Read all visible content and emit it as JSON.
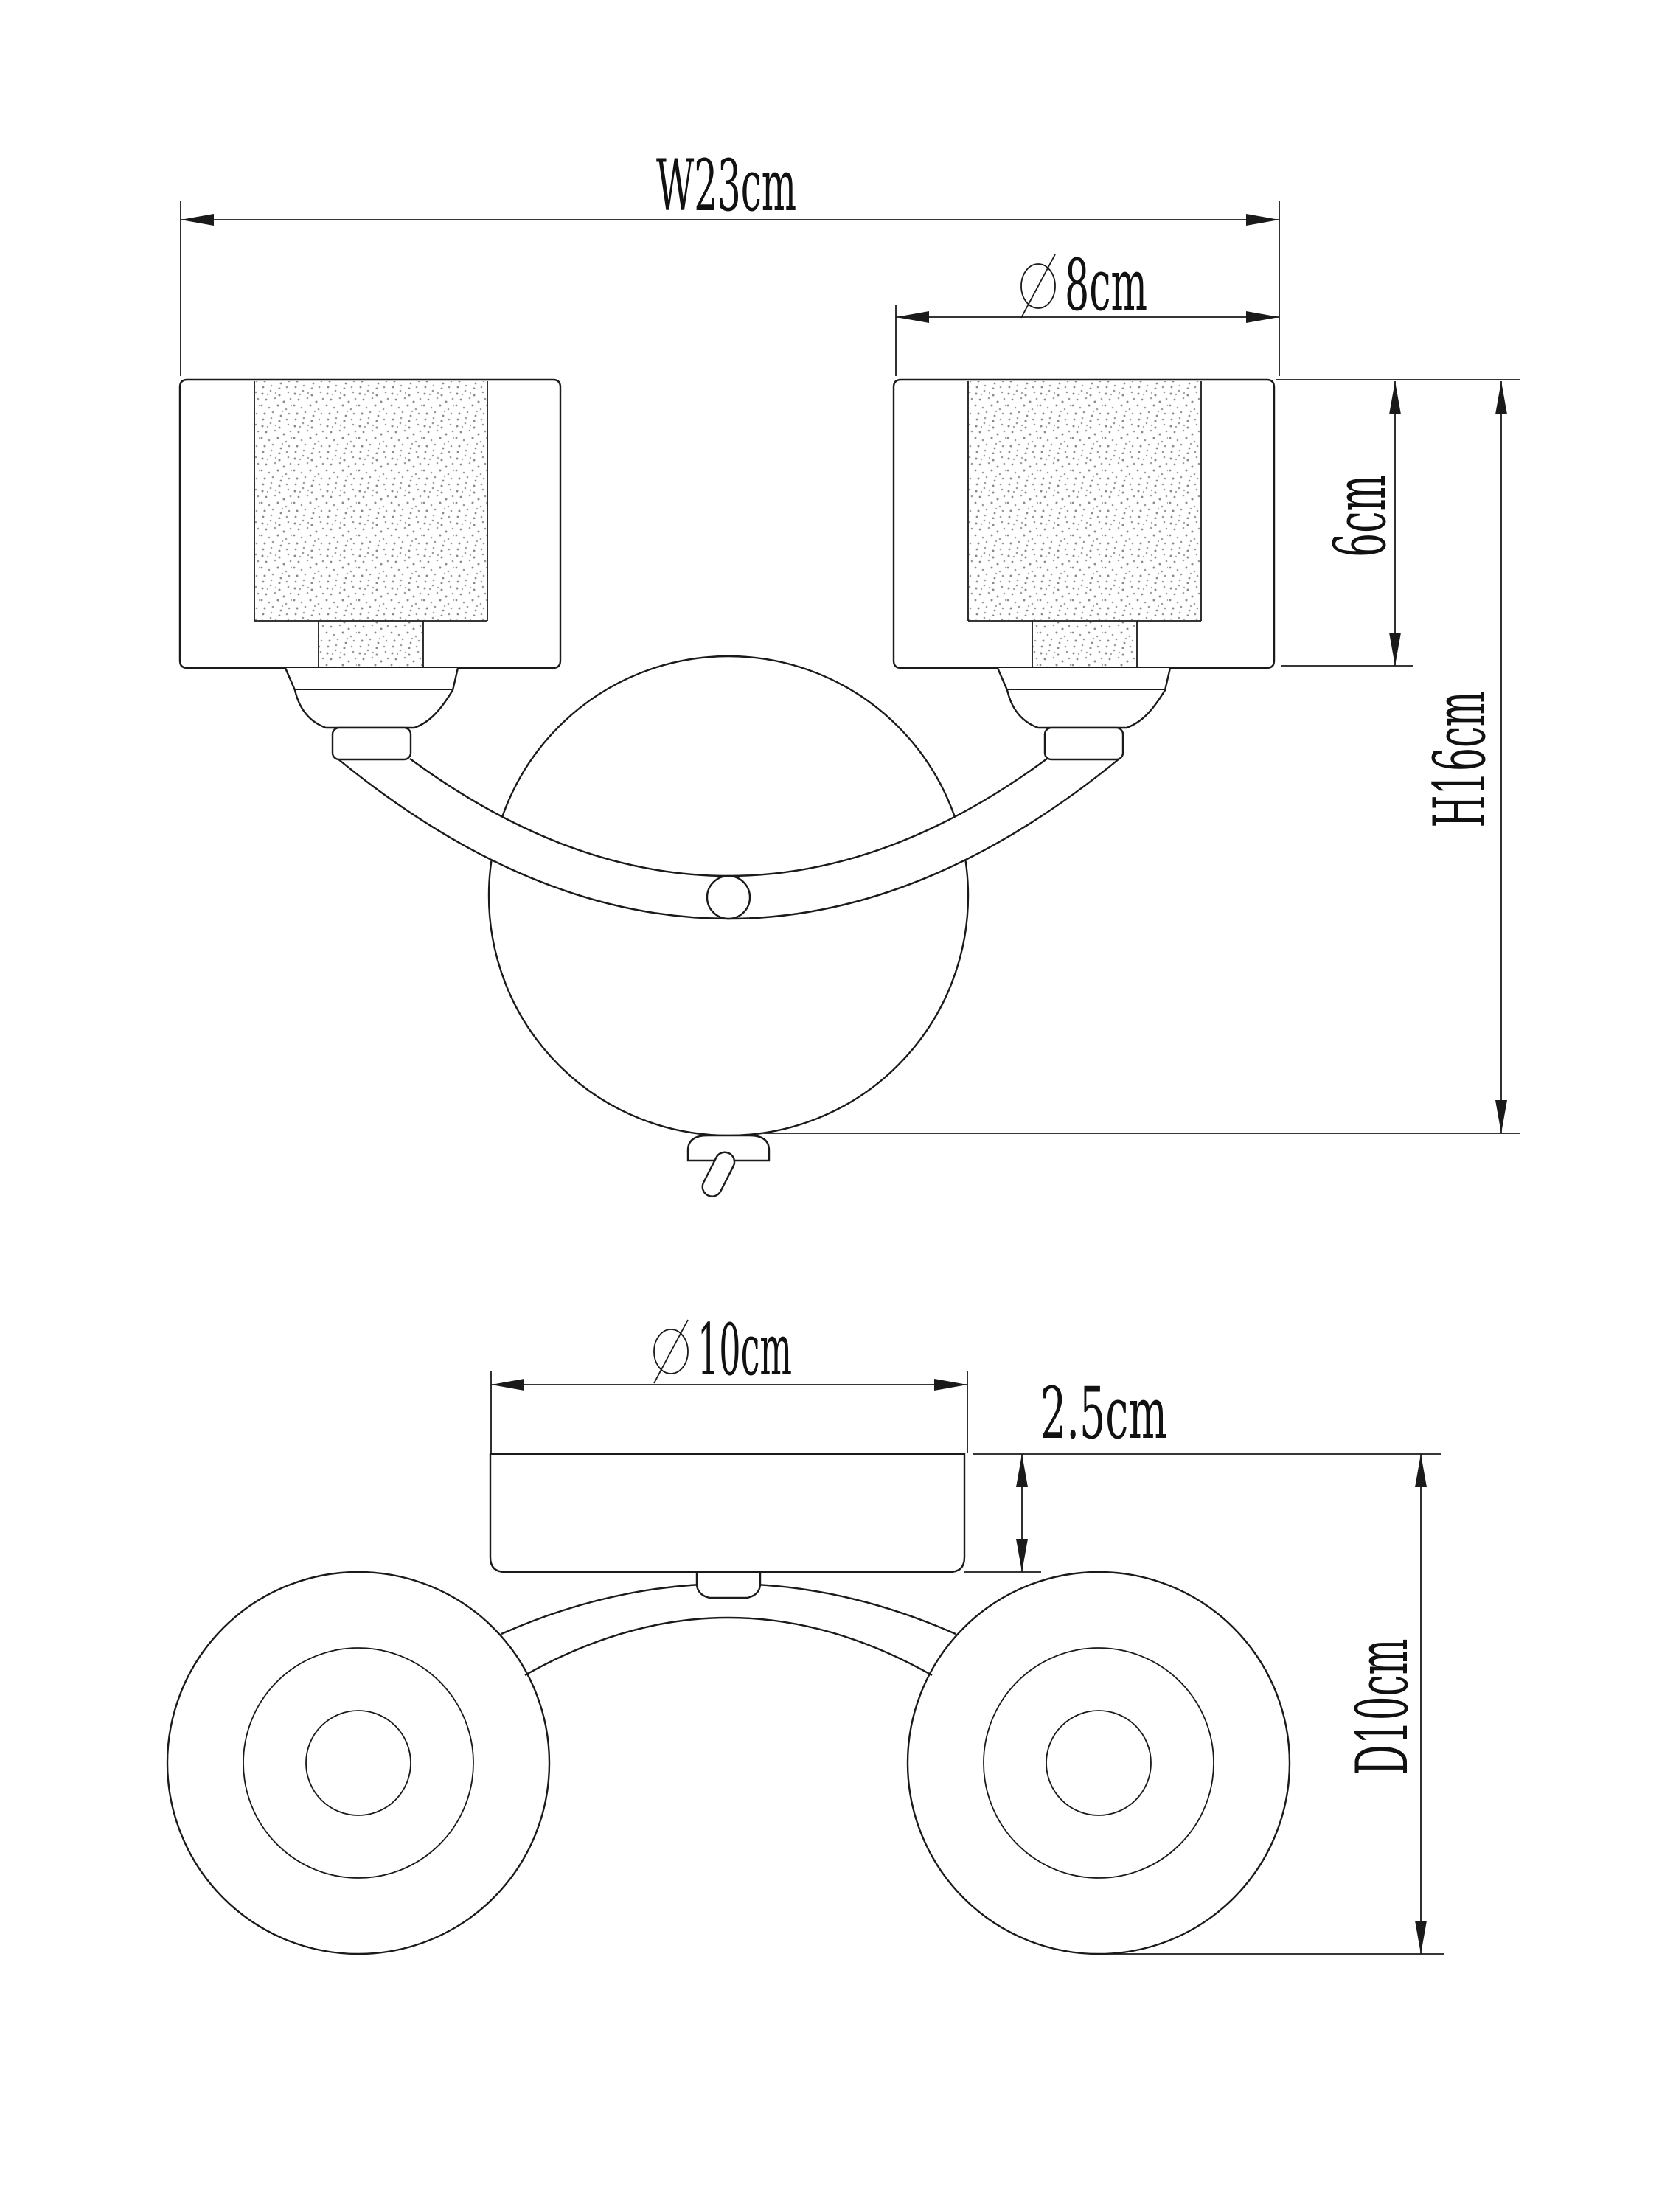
{
  "document": {
    "type": "technical-dimension-drawing",
    "subject": "two-light wall sconce, front view and bottom view",
    "background_color": "#ffffff",
    "line_color": "#1a1a1a"
  },
  "front_view": {
    "dim_width": {
      "label": "W23cm",
      "display_text": "W23cm",
      "value_cm": 23,
      "orientation": "horizontal"
    },
    "dim_shade_diameter": {
      "label": "⌀8cm",
      "display_text": "8cm",
      "value_cm": 8,
      "symbol": "diameter",
      "orientation": "horizontal"
    },
    "dim_shade_height": {
      "label": "6cm",
      "display_text": "6cm",
      "value_cm": 6,
      "orientation": "vertical"
    },
    "dim_total_height": {
      "label": "H16cm",
      "display_text": "H16cm",
      "value_cm": 16,
      "orientation": "vertical"
    }
  },
  "bottom_view": {
    "dim_plate_diameter": {
      "label": "⌀10cm",
      "display_text": "10cm",
      "value_cm": 10,
      "symbol": "diameter",
      "orientation": "horizontal"
    },
    "dim_plate_thickness": {
      "label": "2.5cm",
      "display_text": "2.5cm",
      "value_cm": 2.5,
      "orientation": "vertical"
    },
    "dim_depth": {
      "label": "D10cm",
      "display_text": "D10cm",
      "value_cm": 10,
      "orientation": "vertical"
    }
  }
}
